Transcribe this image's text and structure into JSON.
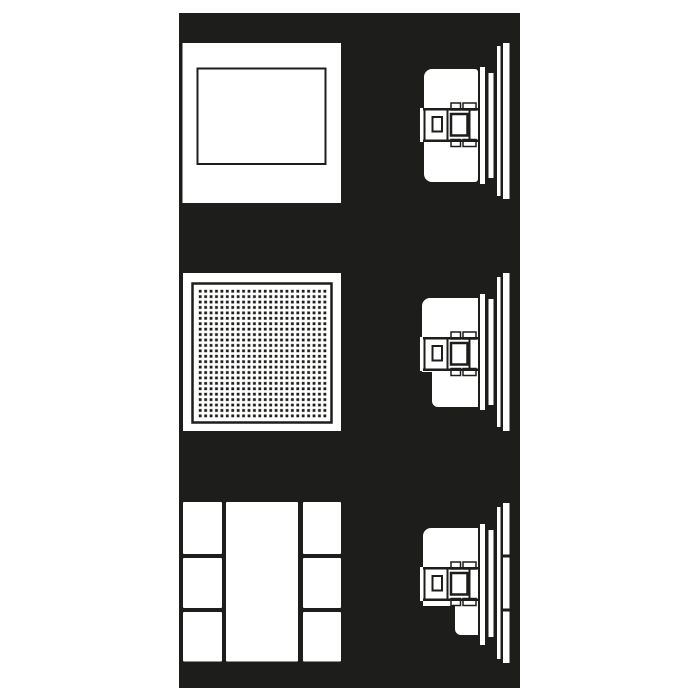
{
  "figure": {
    "kind": "technical-line-drawing",
    "aria_label": "Technical line drawing on a black panel showing three flush-mounted wall units stacked vertically: a blank cover plate, a perforated speaker grille plate, and a three-column module frame. Each front view has a matching side profile view on the right showing the recessed housing, claw fixing, trim rings and wall surface.",
    "colors": {
      "canvas": "#ffffff",
      "ink": "#1d1d1b",
      "line": "#ffffff"
    },
    "rows": [
      {
        "label": "blank cover plate",
        "front": "square plate with recessed rectangular field",
        "side": "flush-mount housing with claw fixing, mounting flange, spacer ring and wall line"
      },
      {
        "label": "speaker grille plate",
        "front": "square plate with perforated grille field of small square holes (about 24 x 24)",
        "side": "flush-mount housing with claw fixing and single stepped base"
      },
      {
        "label": "three-module frame",
        "front": "frame with three columns: three small fields, one tall centre field, three small fields",
        "side": "flush-mount housing with claw fixing, double-stepped base and cover trim segmented into three parts"
      }
    ]
  }
}
